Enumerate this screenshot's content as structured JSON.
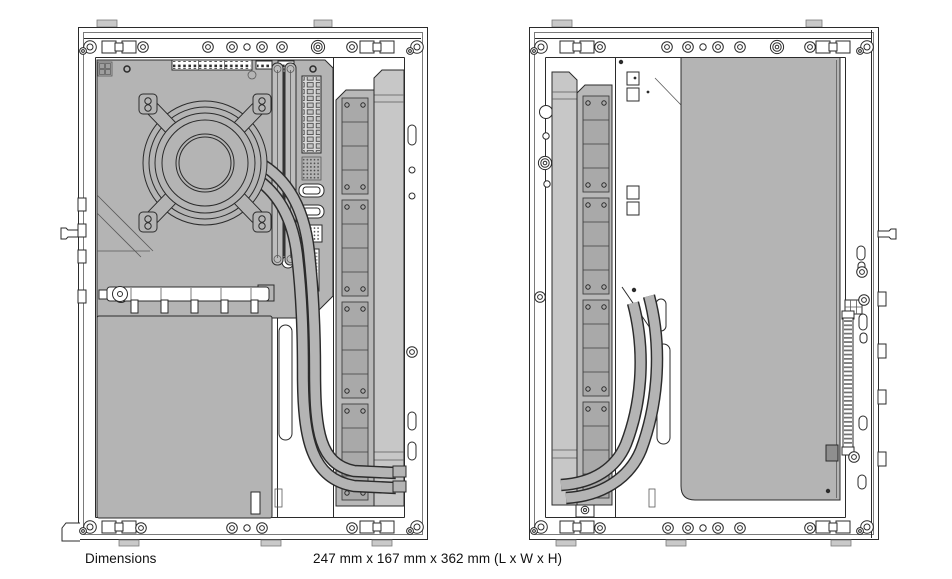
{
  "caption": {
    "label": "Dimensions",
    "value": "247 mm x 167 mm x 362 mm (L x W x H)"
  },
  "figure": {
    "kind": "technical-line-drawing",
    "views": [
      "left-side-internal-view",
      "right-side-internal-view"
    ]
  },
  "colors": {
    "background": "#ffffff",
    "line": "#2b2b2b",
    "line_soft": "#5a5a5a",
    "component_gray": "#b4b4b4",
    "radiator_gray": "#c7c7c7",
    "fan_gray": "#a9a9a9",
    "dark_gray": "#8f8f8f",
    "text": "#111111"
  }
}
